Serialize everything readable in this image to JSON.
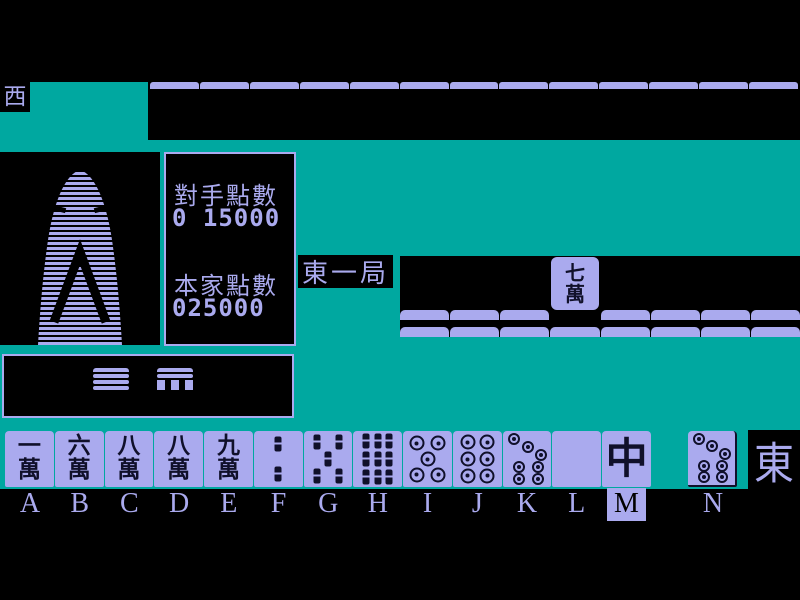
{
  "colors": {
    "background": "#000000",
    "table_teal": "#00A8A0",
    "tile_lavender": "#AAAAEE",
    "glyph_dark": "#10102a"
  },
  "indicators": {
    "left_wind": "西",
    "player_wind": "東",
    "round": "東一局"
  },
  "score_panel": {
    "opponent_label": "對手點數",
    "opponent_value": "0 15000",
    "self_label": "本家點數",
    "self_value": "025000"
  },
  "discard": {
    "tile_top": "七",
    "tile_bottom": "萬"
  },
  "opponent_hand": {
    "tile_count": 13
  },
  "wall_rows": {
    "upper": {
      "segments": 8,
      "gap_index": 3
    },
    "lower": {
      "segments": 8
    }
  },
  "hand": {
    "letters": [
      "A",
      "B",
      "C",
      "D",
      "E",
      "F",
      "G",
      "H",
      "I",
      "J",
      "K",
      "L",
      "M",
      "N"
    ],
    "selected_letter": "M",
    "tiles": [
      {
        "label": "A",
        "type": "man",
        "top": "一",
        "bottom": "萬"
      },
      {
        "label": "B",
        "type": "man",
        "top": "六",
        "bottom": "萬"
      },
      {
        "label": "C",
        "type": "man",
        "top": "八",
        "bottom": "萬"
      },
      {
        "label": "D",
        "type": "man",
        "top": "八",
        "bottom": "萬"
      },
      {
        "label": "E",
        "type": "man",
        "top": "九",
        "bottom": "萬"
      },
      {
        "label": "F",
        "type": "sou",
        "value": 2
      },
      {
        "label": "G",
        "type": "sou",
        "value": 5
      },
      {
        "label": "H",
        "type": "sou",
        "value": 9
      },
      {
        "label": "I",
        "type": "pin",
        "value": 5
      },
      {
        "label": "J",
        "type": "pin",
        "value": 6
      },
      {
        "label": "K",
        "type": "pin",
        "value": 7
      },
      {
        "label": "L",
        "type": "blank",
        "name": "haku-white-dragon"
      },
      {
        "label": "M",
        "type": "honor",
        "kanji": "中",
        "name": "chun-red-dragon"
      }
    ],
    "drawn_tile": {
      "label": "N",
      "type": "pin",
      "value": 7
    }
  }
}
